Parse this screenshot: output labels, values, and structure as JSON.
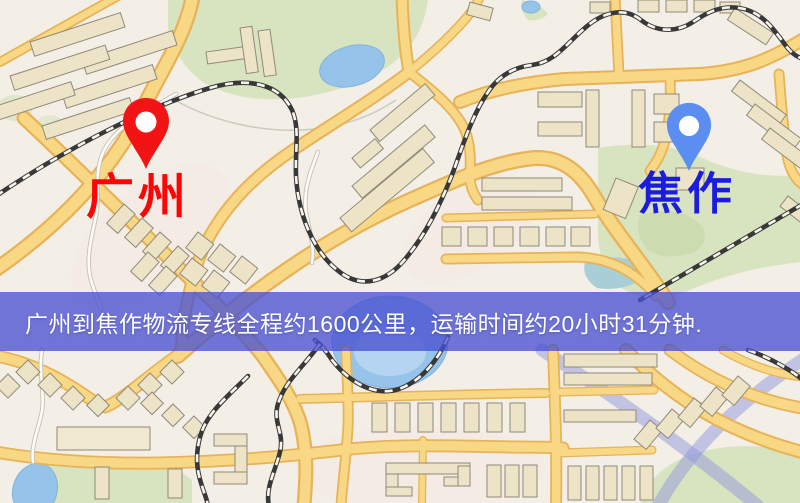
{
  "banner": {
    "text": "广州到焦作物流专线全程约1600公里，运输时间约20小时31分钟.",
    "distance_km": "1600",
    "duration": "20小时31分钟",
    "bg_color": "#4951D1",
    "text_color": "#FFFFFF"
  },
  "markers": {
    "origin": {
      "label": "广州",
      "pin_color": "#F21414",
      "label_color": "#FB0606"
    },
    "destination": {
      "label": "焦作",
      "pin_color": "#5C8DF0",
      "label_color": "#1C1CDF"
    }
  },
  "map_palette": {
    "background": "#F3EFE7",
    "road_fill": "#F8D884",
    "road_casing": "#E7B258",
    "minor_road": "#FDFCF8",
    "railway": "#383838",
    "water": "#96C3E9",
    "park_green": "#D8E3BF",
    "building": "#EDE4C8",
    "building_outline": "#91897A",
    "highway_blue": "#9198DD"
  }
}
